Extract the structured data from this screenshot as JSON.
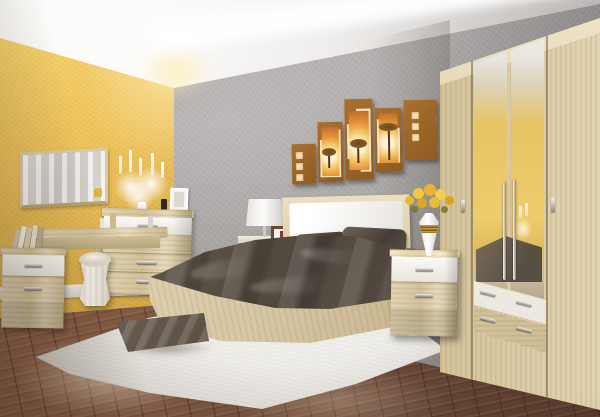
{
  "meta": {
    "domain": "natural-image",
    "subject": "bedroom furniture set showroom photo",
    "description": "3D rendered bedroom with sonoma-oak and white furniture: bed with white upholstered headboard and dark satin bedding, four-door mirrored wardrobe, vanity table with chest of drawers, two nightstands, white pouf, white shaggy rug with satin floor cushion, five-panel safari wall art, yellow accent wall, gray wallpaper, diagonal brown laminate floor, cove-lit white ceiling"
  },
  "palette": {
    "yellow_wall_light": "#f6d36b",
    "yellow_wall_mid": "#eec055",
    "yellow_wall_dark": "#c99c3e",
    "gray_wall": "#a5a1a0",
    "gray_wall_light": "#b8b4b3",
    "gray_wall_dark": "#86817e",
    "ceiling_white": "#faf9f7",
    "ceiling_shadow": "#b3b0af",
    "floor_light": "#9a6b4e",
    "floor_mid": "#7a5440",
    "floor_dark": "#55392b",
    "oak_light": "#e8dcc0",
    "oak_mid": "#d6c6a2",
    "oak_dark": "#b9a67e",
    "white_furniture": "#f4f1eb",
    "metal_handle": "#b9b4aa",
    "bedding_dark": "#4a423a",
    "bedding_mid": "#625749",
    "bedding_light": "#8a7d6e",
    "rug_white": "#ece8e0",
    "art_brown": "#9c6527",
    "art_cream": "#f3e2bd",
    "art_orange": "#e8953a",
    "flower_yellow": "#e9b92c"
  },
  "room": {
    "left_wall": "textured mustard-yellow accent wall",
    "back_wall": "gray textured wallpaper",
    "ceiling": "white with indirect cove lighting strip",
    "floor": "brown laminate planks laid diagonally",
    "baseboard": "white"
  },
  "objects": {
    "wall_art": {
      "panels": 5,
      "theme": "african savanna trees at sunset",
      "colors": [
        "brown",
        "cream",
        "orange"
      ],
      "layout": "staggered heights above headboard"
    },
    "wall_mirror": {
      "shape": "horizontal rectangle",
      "frame": "oak"
    },
    "candelabra": {
      "color": "white",
      "candles": 5,
      "decor": "white flowers and butterflies"
    },
    "vanity_table": {
      "finish": "oak",
      "items_on_top": "perfume bottles"
    },
    "chest_of_drawers": {
      "drawers": 4,
      "top_drawer": "white",
      "lower_drawers": "oak"
    },
    "left_nightstand": {
      "drawers": 2,
      "top_drawer": "white",
      "items_on_top": "leaning books"
    },
    "pouf": {
      "color": "cream",
      "shape": "hourglass cylinder"
    },
    "bed": {
      "frame": "oak",
      "headboard": "white upholstered panel in oak frame",
      "bedding": "dark taupe satin duvet and pillows"
    },
    "table_lamp": {
      "shade": "white cylinder"
    },
    "small_frames": [
      "white frame on chest",
      "dark brown frame beside lamp"
    ],
    "right_nightstand": {
      "drawers": 2,
      "top_drawer": "white",
      "items_on_top": "white-gold vase with yellow roses"
    },
    "wardrobe": {
      "doors": 4,
      "mirror_doors": 2,
      "drawers": 2,
      "drawer_colors": [
        "white",
        "oak"
      ],
      "finish": "oak",
      "handles": "metal"
    },
    "rug": {
      "type": "white shaggy",
      "shape": "rectangle in perspective"
    },
    "floor_cushion": {
      "color": "gray-brown satin"
    }
  }
}
